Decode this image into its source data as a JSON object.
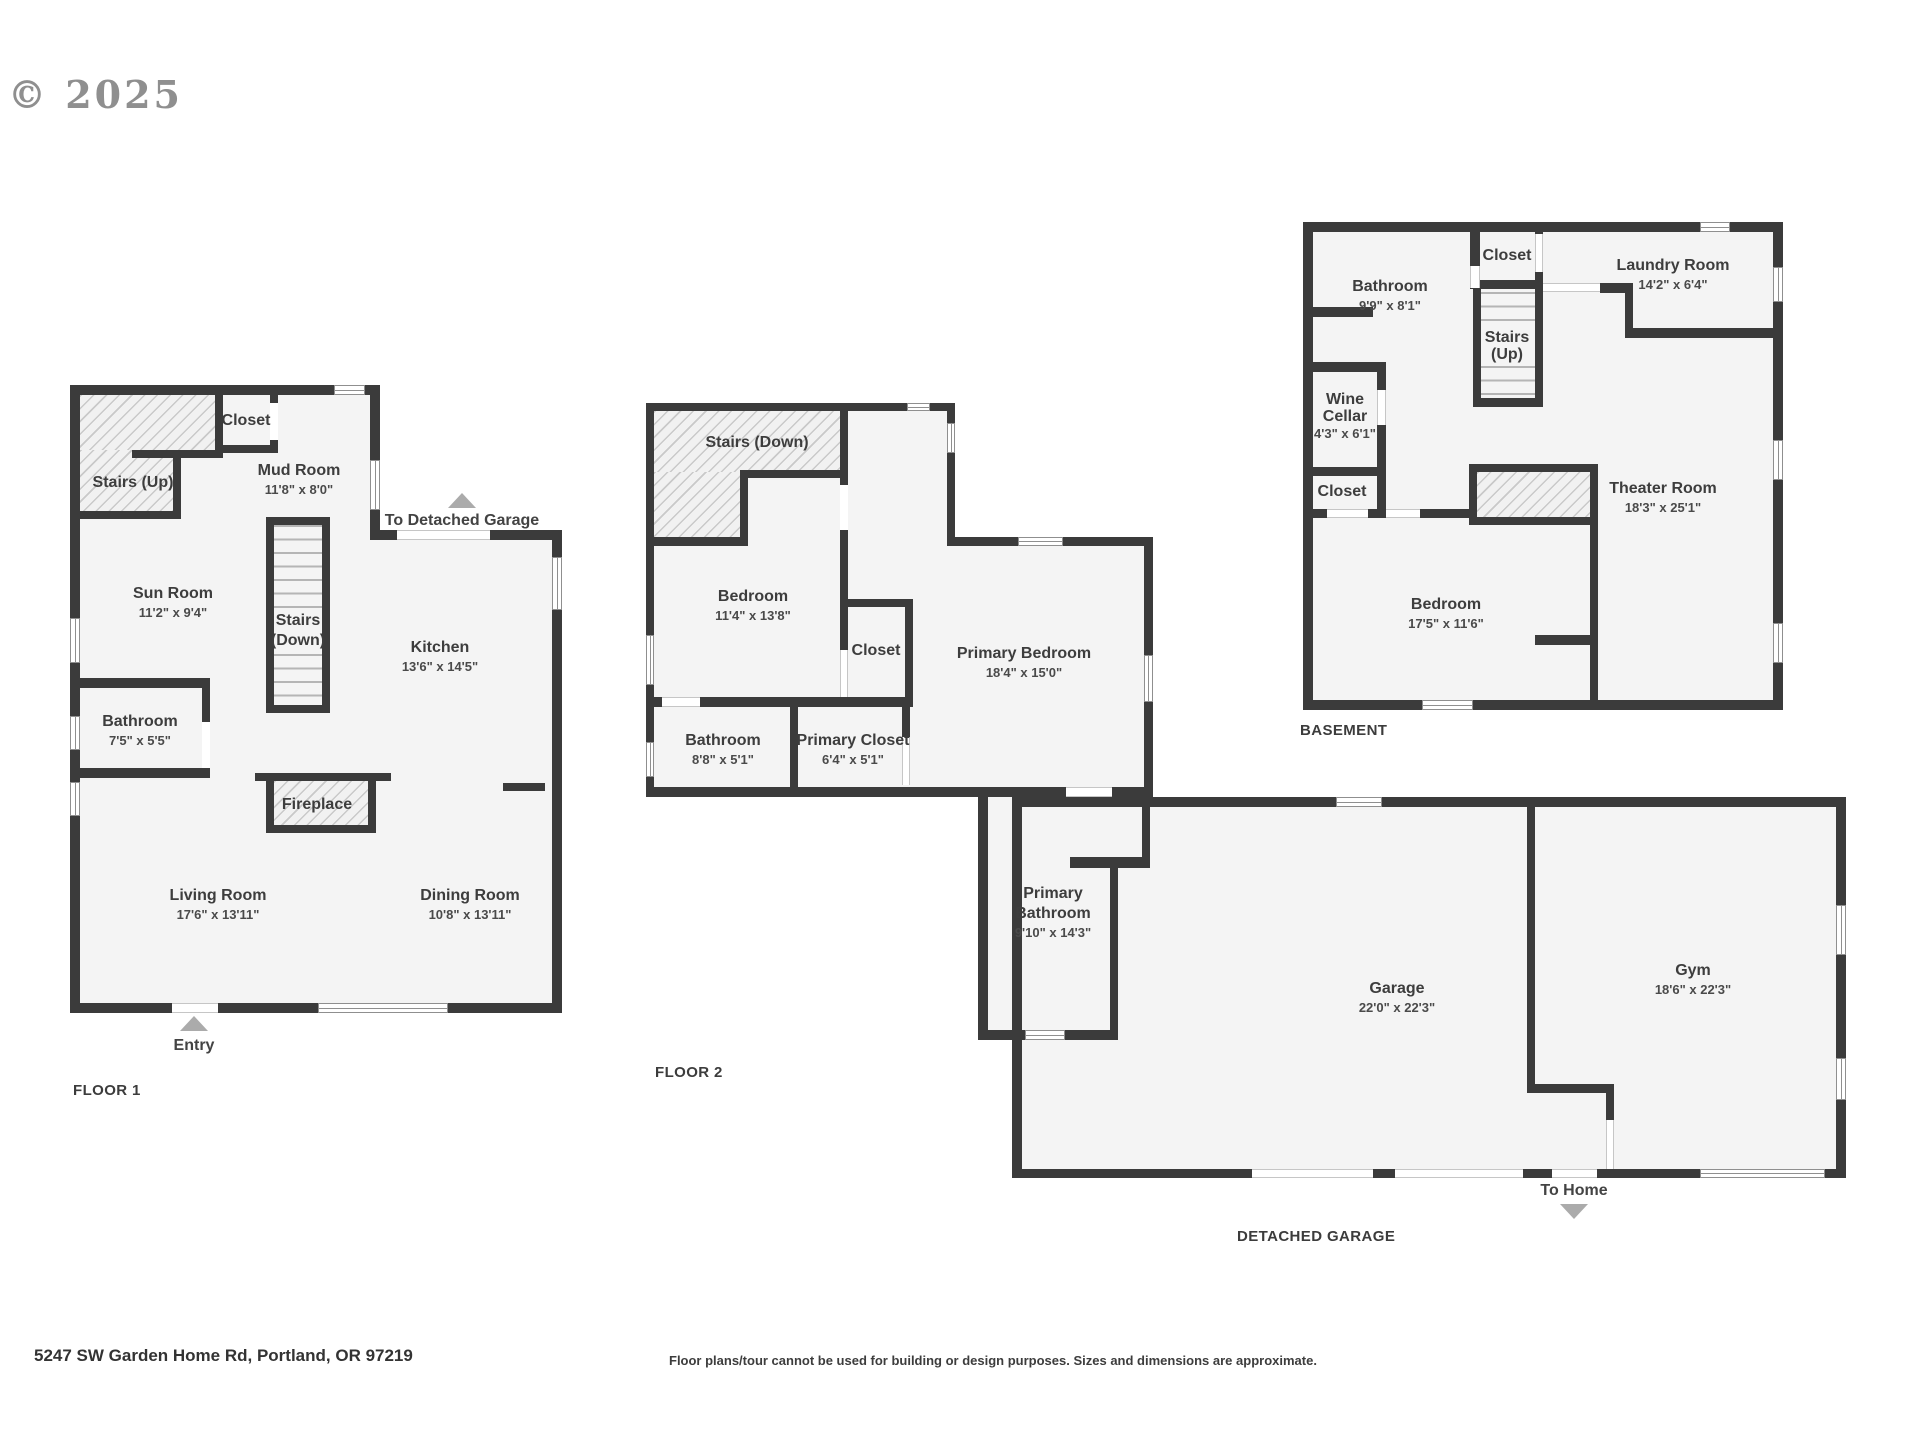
{
  "copyright": "© 2025",
  "footer": {
    "address": "5247 SW Garden Home Rd, Portland, OR 97219",
    "disclaimer": "Floor plans/tour cannot be used for building or design purposes. Sizes and dimensions are approximate."
  },
  "colors": {
    "wall": "#3b3b3b",
    "floor_fill": "#f4f4f4",
    "label_text": "#404040",
    "arrow": "#ababab"
  },
  "floor1": {
    "label": "FLOOR 1",
    "stairs_up": "Stairs (Up)",
    "closet": "Closet",
    "mud_room": {
      "name": "Mud Room",
      "dims": "11'8\" x 8'0\""
    },
    "to_garage": "To Detached Garage",
    "sun_room": {
      "name": "Sun Room",
      "dims": "11'2\" x 9'4\""
    },
    "stairs_down": [
      "Stairs",
      "(Down)"
    ],
    "kitchen": {
      "name": "Kitchen",
      "dims": "13'6\" x 14'5\""
    },
    "bathroom": {
      "name": "Bathroom",
      "dims": "7'5\" x 5'5\""
    },
    "fireplace": "Fireplace",
    "living_room": {
      "name": "Living Room",
      "dims": "17'6\" x 13'11\""
    },
    "dining_room": {
      "name": "Dining Room",
      "dims": "10'8\" x 13'11\""
    },
    "entry": "Entry"
  },
  "floor2": {
    "label": "FLOOR 2",
    "stairs_down": "Stairs (Down)",
    "bedroom": {
      "name": "Bedroom",
      "dims": "11'4\" x 13'8\""
    },
    "closet": "Closet",
    "primary_bedroom": {
      "name": "Primary Bedroom",
      "dims": "18'4\" x 15'0\""
    },
    "bathroom": {
      "name": "Bathroom",
      "dims": "8'8\" x 5'1\""
    },
    "primary_closet": {
      "name": "Primary Closet",
      "dims": "6'4\" x 5'1\""
    },
    "primary_bathroom": [
      "Primary",
      "Bathroom",
      "9'10\" x 14'3\""
    ]
  },
  "basement": {
    "label": "BASEMENT",
    "bathroom": {
      "name": "Bathroom",
      "dims": "9'9\" x 8'1\""
    },
    "closet_top": "Closet",
    "laundry_room": {
      "name": "Laundry Room",
      "dims": "14'2\" x 6'4\""
    },
    "stairs_up": [
      "Stairs",
      "(Up)"
    ],
    "wine_cellar": [
      "Wine",
      "Cellar",
      "4'3\" x 6'1\""
    ],
    "closet_left": "Closet",
    "theater_room": {
      "name": "Theater Room",
      "dims": "18'3\" x 25'1\""
    },
    "bedroom": {
      "name": "Bedroom",
      "dims": "17'5\" x 11'6\""
    }
  },
  "detached_garage": {
    "label": "DETACHED GARAGE",
    "garage": {
      "name": "Garage",
      "dims": "22'0\" x 22'3\""
    },
    "gym": {
      "name": "Gym",
      "dims": "18'6\" x 22'3\""
    },
    "to_home": "To Home"
  }
}
